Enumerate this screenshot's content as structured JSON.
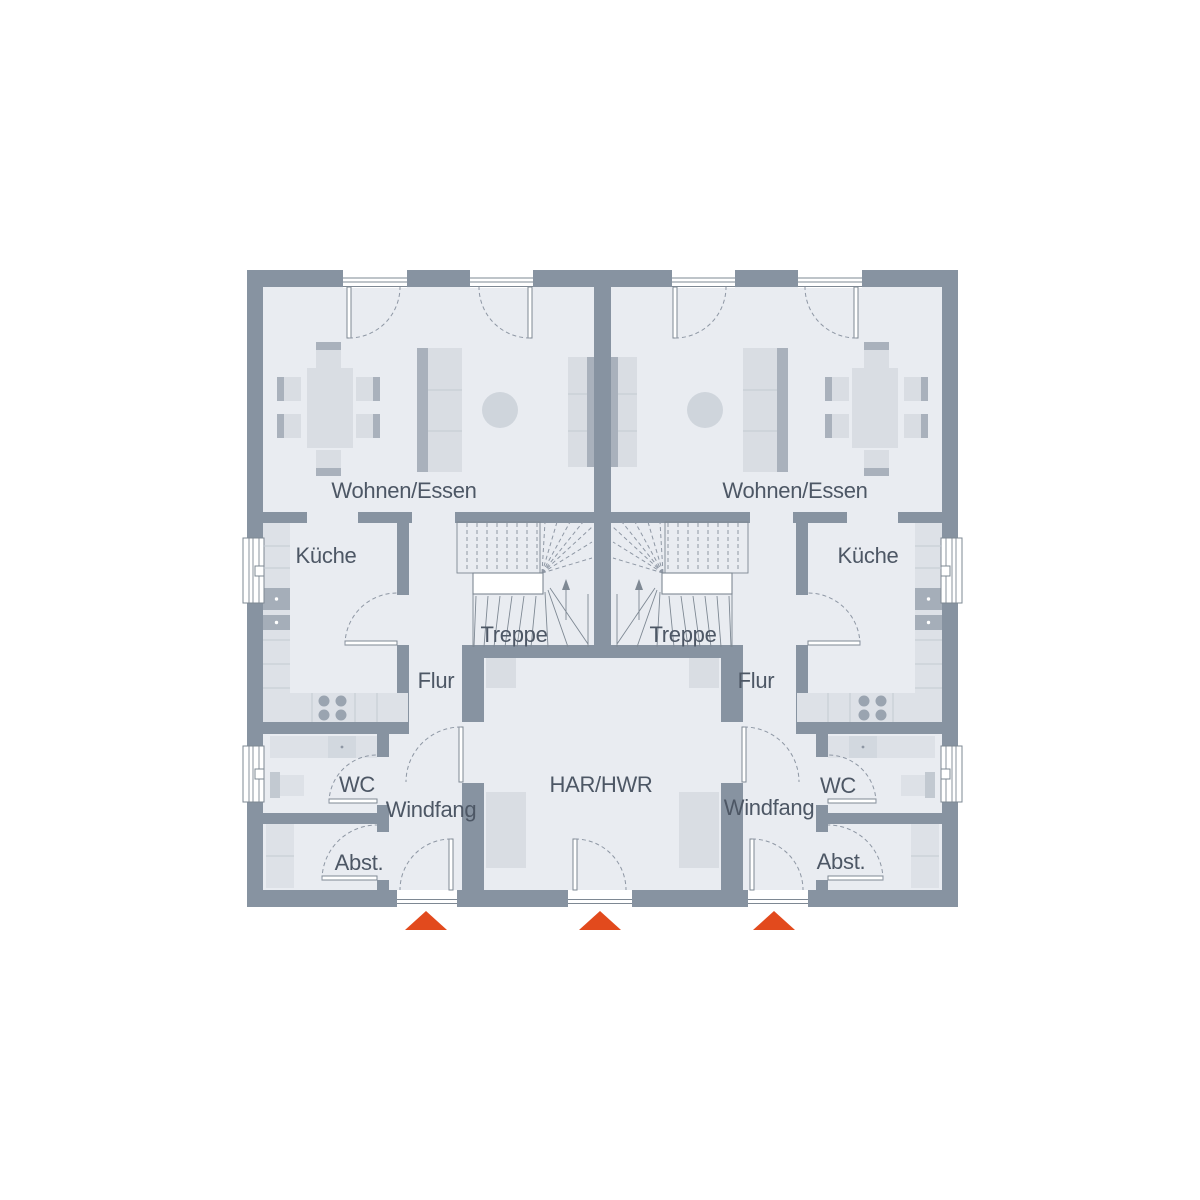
{
  "floorplan": {
    "type": "duplex-ground-floor-plan",
    "units": [
      {
        "id": "left",
        "rooms": [
          {
            "name": "wohnen-essen",
            "label": "Wohnen/Essen"
          },
          {
            "name": "kueche",
            "label": "Küche"
          },
          {
            "name": "treppe",
            "label": "Treppe"
          },
          {
            "name": "flur",
            "label": "Flur"
          },
          {
            "name": "wc",
            "label": "WC"
          },
          {
            "name": "windfang",
            "label": "Windfang"
          },
          {
            "name": "abstellraum",
            "label": "Abst."
          }
        ]
      },
      {
        "id": "right",
        "rooms": [
          {
            "name": "wohnen-essen",
            "label": "Wohnen/Essen"
          },
          {
            "name": "kueche",
            "label": "Küche"
          },
          {
            "name": "treppe",
            "label": "Treppe"
          },
          {
            "name": "flur",
            "label": "Flur"
          },
          {
            "name": "wc",
            "label": "WC"
          },
          {
            "name": "windfang",
            "label": "Windfang"
          },
          {
            "name": "abstellraum",
            "label": "Abst."
          }
        ]
      }
    ],
    "shared_rooms": [
      {
        "name": "har-hwr",
        "label": "HAR/HWR"
      }
    ],
    "entrance_markers": {
      "count": 3,
      "shape": "triangle-up"
    },
    "colors": {
      "wall": "#8793a1",
      "floor": "#e9ecf1",
      "furniture_light": "#d9dde3",
      "furniture_dark": "#a9b1bc",
      "rug": "#cfd5dc",
      "counter": "#dde1e7",
      "counter_dark": "#d2d8df",
      "appliance_dark": "#a5aeb9",
      "accent_red": "#e24a1d",
      "label_text": "#4d5765",
      "line": "#7e8893"
    }
  }
}
